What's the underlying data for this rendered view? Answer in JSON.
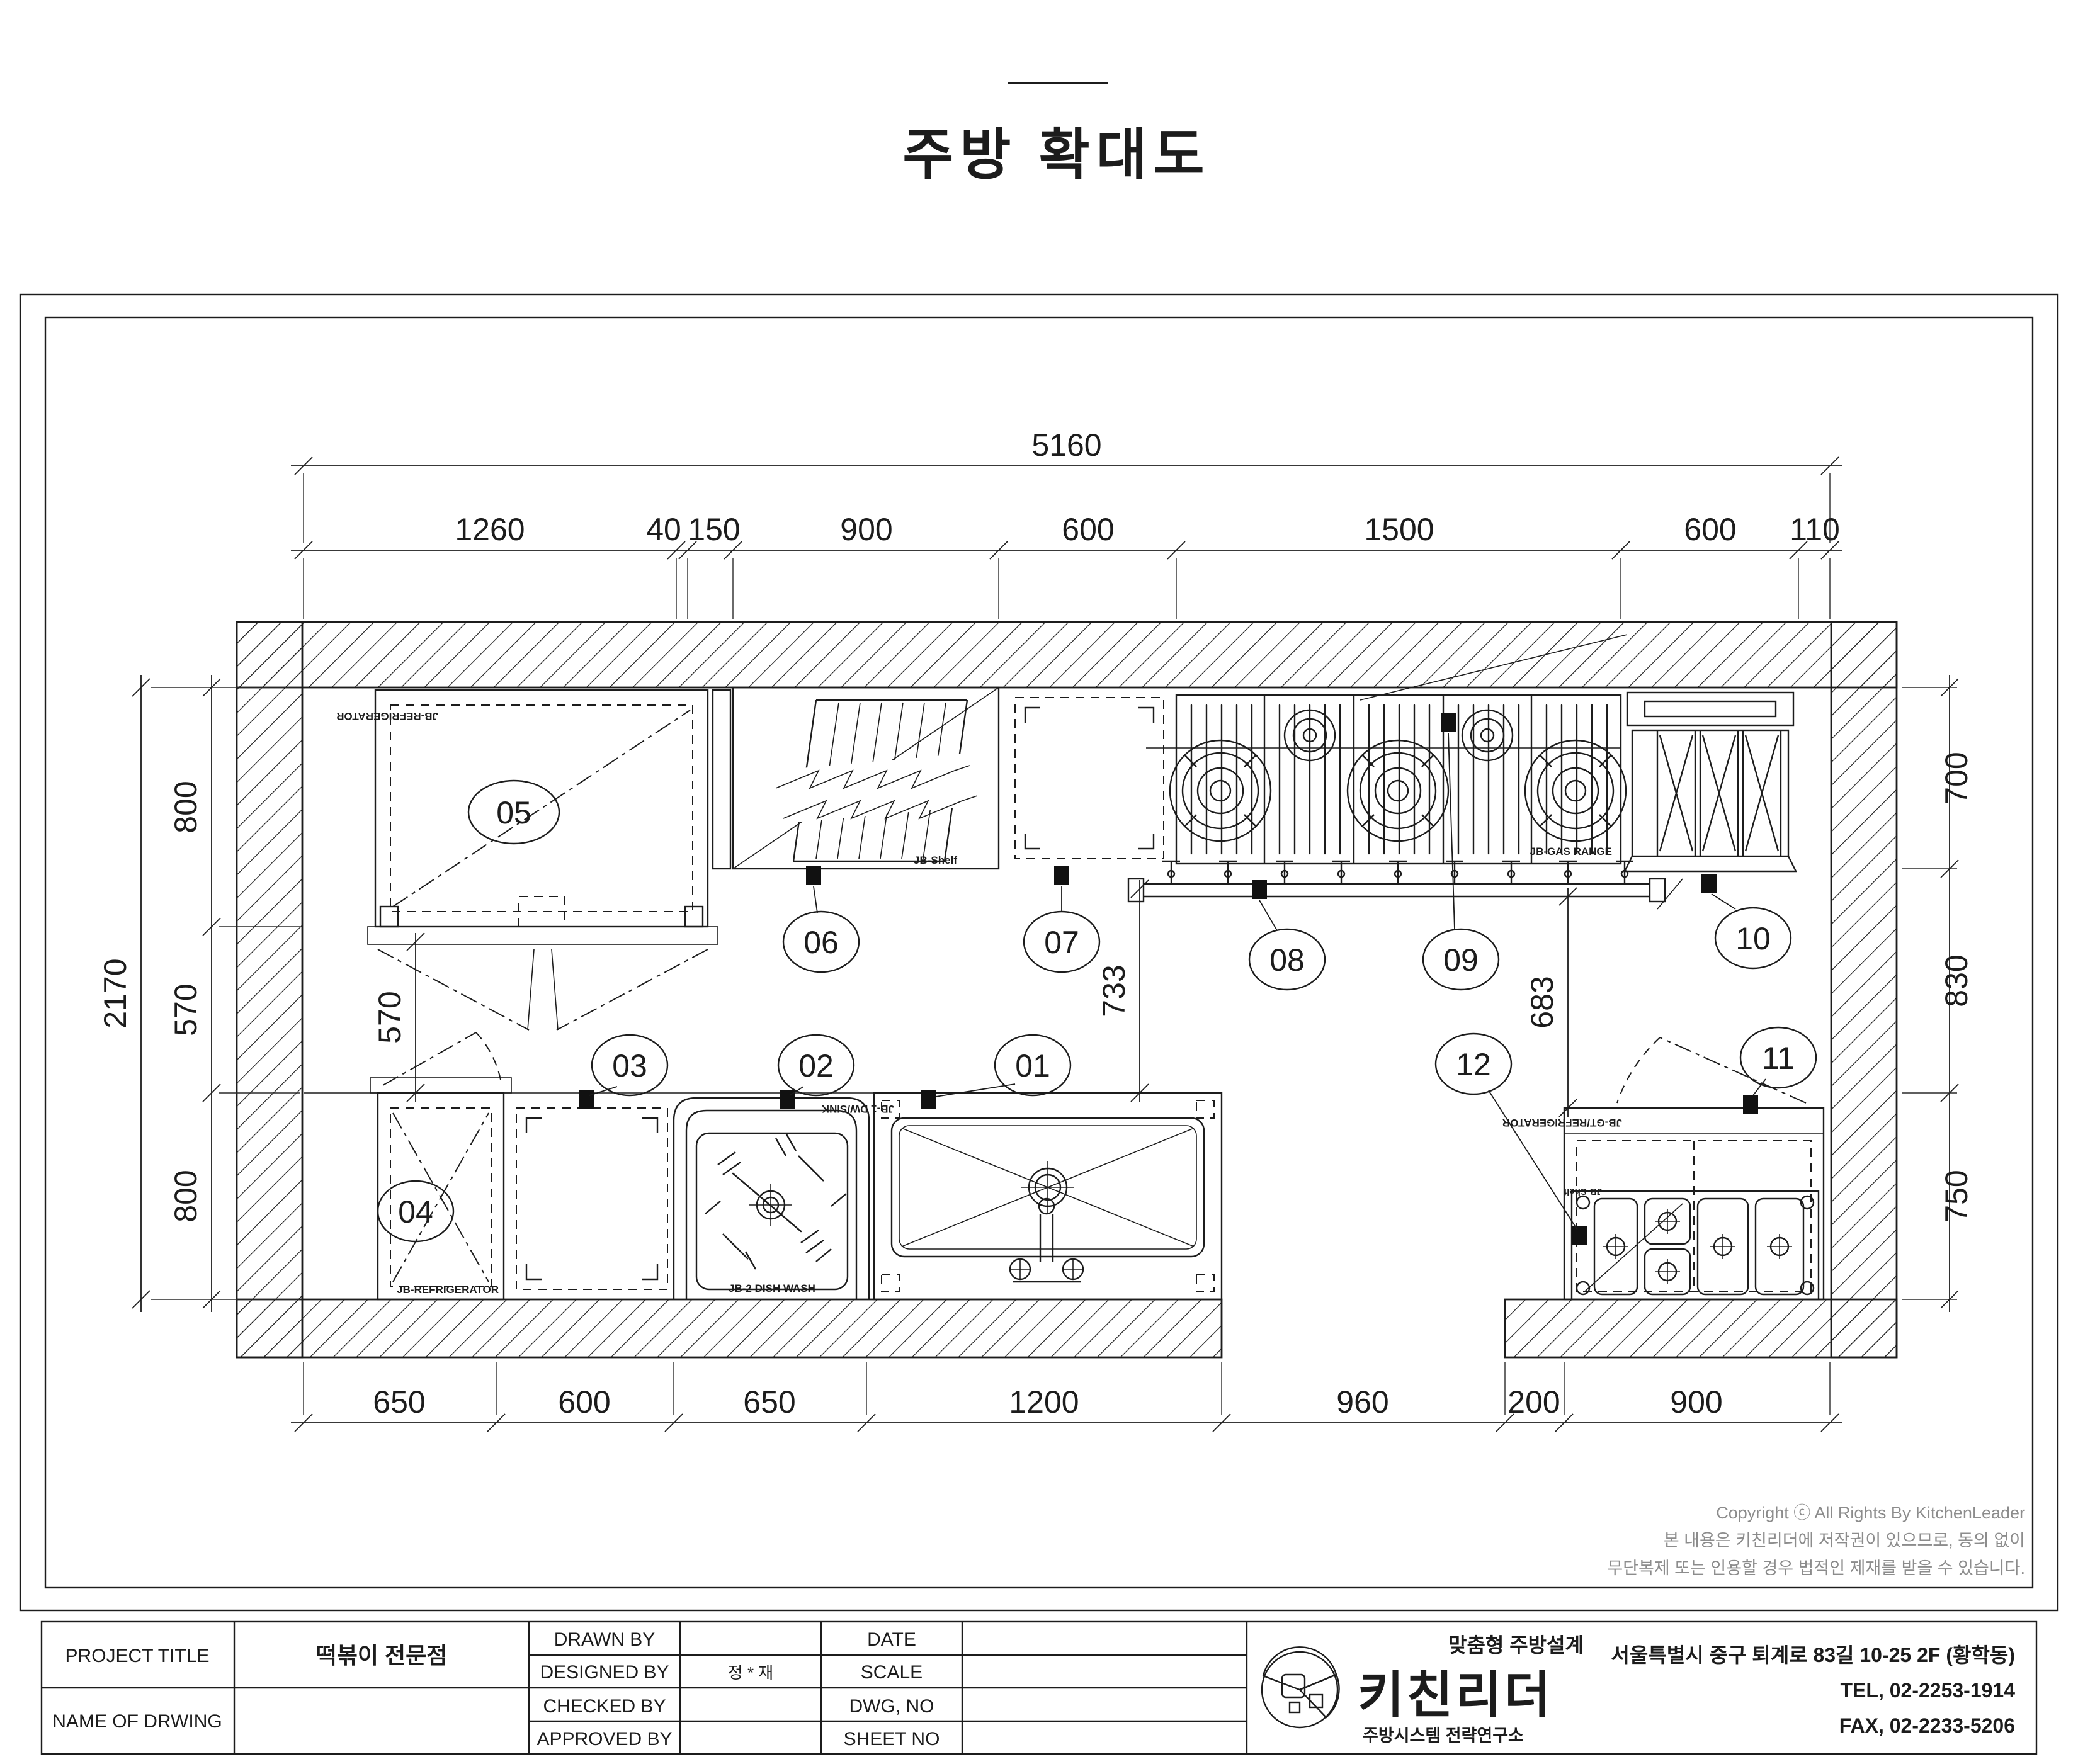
{
  "page": {
    "title": "주방 확대도"
  },
  "dims": {
    "top_total": "5160",
    "top_segments": [
      "1260",
      "40",
      "150",
      "900",
      "600",
      "1500",
      "600",
      "110"
    ],
    "left_total": "2170",
    "left_segments": [
      "800",
      "570",
      "800"
    ],
    "right_segments": [
      "700",
      "830",
      "750"
    ],
    "bottom_segments": [
      "650",
      "600",
      "650",
      "1200",
      "960",
      "200",
      "900"
    ],
    "interior": {
      "door_gap": "570",
      "sink_clearance": "733",
      "right_clearance": "683"
    }
  },
  "bubbles": [
    "01",
    "02",
    "03",
    "04",
    "05",
    "06",
    "07",
    "08",
    "09",
    "10",
    "11",
    "12"
  ],
  "units": {
    "u05": {
      "label": "JB-REFRIGERATOR"
    },
    "u06": {
      "label": "JB-Shelf"
    },
    "u0809": {
      "label": "JB-GAS RANGE"
    },
    "u04": {
      "label": "JB-REFRIGERATOR"
    },
    "u02": {
      "label": "JB-2 DISH WASH"
    },
    "u01": {
      "label": "JB-1 DW/SINK"
    },
    "u1112": {
      "label_top": "JB-GT/REFRIGERATOR",
      "label_shelf": "JB-Shelf"
    }
  },
  "copyright": {
    "line1": "Copyright ⓒ All Rights By KitchenLeader",
    "line2": "본 내용은 키친리더에 저작권이 있으므로, 동의 없이",
    "line3": "무단복제 또는 인용할 경우 법적인 제재를 받을 수 있습니다."
  },
  "title_block": {
    "project_title_label": "PROJECT TITLE",
    "project_title_value": "떡볶이 전문점",
    "name_of_drawing_label": "NAME OF DRWING",
    "drawn_by": "DRAWN BY",
    "designed_by": "DESIGNED BY",
    "checked_by": "CHECKED BY",
    "approved_by": "APPROVED BY",
    "designed_by_value": "정 * 재",
    "date": "DATE",
    "scale": "SCALE",
    "dwg_no": "DWG, NO",
    "sheet_no": "SHEET NO"
  },
  "company": {
    "name": "키친리더",
    "tagline": "맞춤형 주방설계",
    "subtitle": "주방시스템 전략연구소",
    "address": "서울특별시 중구 퇴계로 83길 10-25 2F (황학동)",
    "tel": "TEL, 02-2253-1914",
    "fax": "FAX, 02-2233-5206",
    "green": "#8dc63f",
    "gray": "#8a8a8a",
    "dark": "#474038"
  }
}
